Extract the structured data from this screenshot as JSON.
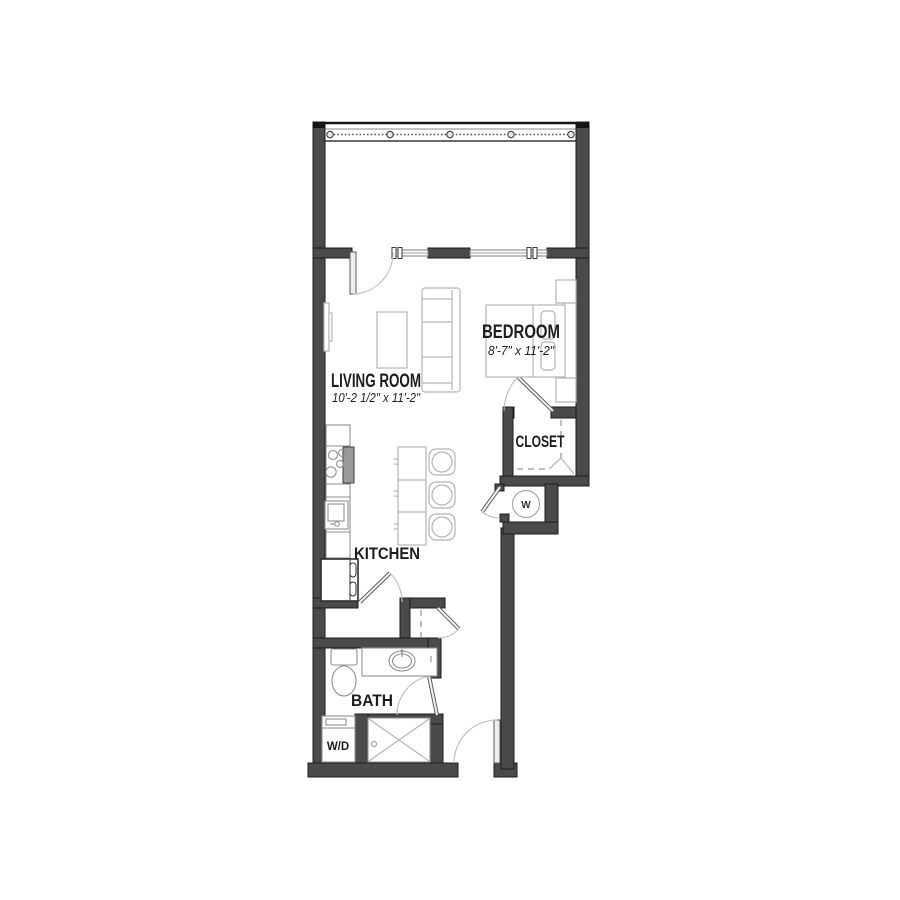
{
  "plan": {
    "name": "Studio Apartment Floor Plan",
    "colors": {
      "wall": "#4a4a4a",
      "wall_edge": "#1c1c1c",
      "furniture_line": "#b5b5b5",
      "fixture_line": "#8f8f8f",
      "label_text": "#1d1d1d"
    },
    "rooms": {
      "living_room": {
        "label": "LIVING ROOM",
        "dimensions": "10'-2 1/2\" x 11'-2\""
      },
      "bedroom": {
        "label": "BEDROOM",
        "dimensions": "8'-7\" x 11'-2\""
      },
      "closet": {
        "label": "CLOSET"
      },
      "kitchen": {
        "label": "KITCHEN"
      },
      "bath": {
        "label": "BATH"
      },
      "laundry": {
        "label": "W/D"
      },
      "water_heater": {
        "label": "W"
      }
    }
  }
}
